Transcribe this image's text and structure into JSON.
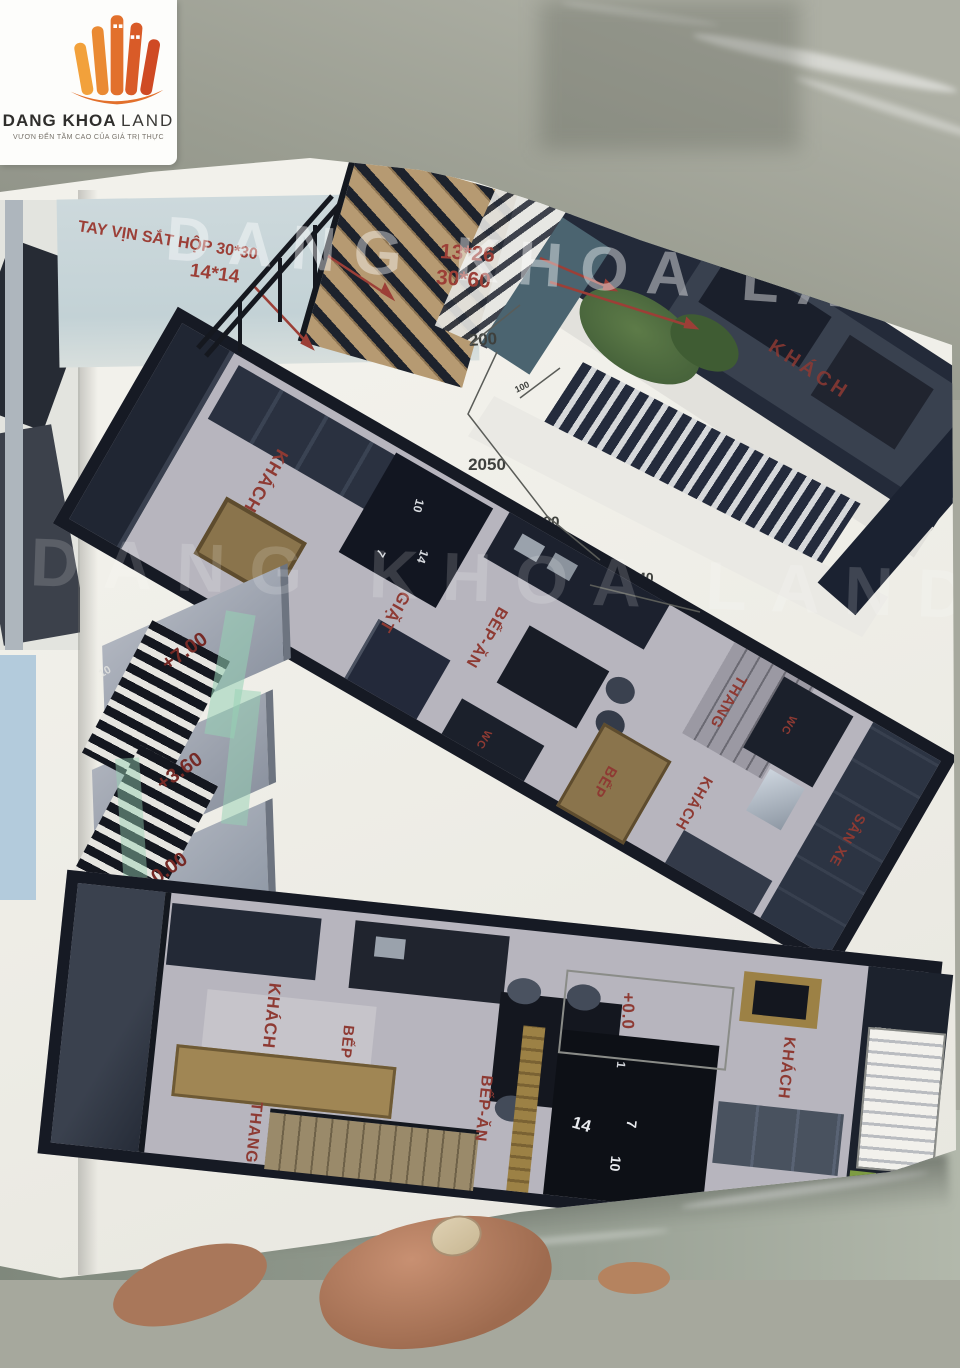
{
  "logo": {
    "brand_bold": "DANG KHOA",
    "brand_light": "LAND",
    "tagline": "VƯƠN ĐẾN TẦM CAO CỦA GIÁ TRỊ THỰC"
  },
  "watermark": {
    "main": "DANG KHOA LAND"
  },
  "colors": {
    "brand_orange": "#e8792f",
    "label_red": "#8e3a33",
    "paper": "#f0efe9",
    "marble": "#a6a89d",
    "plan_wall": "#161a24"
  },
  "annotations": {
    "handrail_note": "TAY VỊN SẮT HỘP 30*30",
    "post_size": "14*14",
    "step_size": "13*26",
    "stringer_size": "30*60"
  },
  "stair_detail": {
    "levels": [
      {
        "label": "+7.00"
      },
      {
        "label": "+3.60"
      },
      {
        "label": "+0.00"
      }
    ],
    "tread_number": "10"
  },
  "plan_top_right": {
    "rooms": [
      {
        "label": "KHÁCH"
      }
    ],
    "dims": [
      {
        "label": "200"
      },
      {
        "label": "100"
      },
      {
        "label": "2050"
      },
      {
        "label": "400"
      },
      {
        "label": "1240"
      }
    ]
  },
  "plan_middle": {
    "rooms": [
      {
        "label": "KHÁCH"
      },
      {
        "label": "GIẶT"
      },
      {
        "label": "BẾP-ĂN"
      },
      {
        "label": "WC"
      },
      {
        "label": "BẾP"
      },
      {
        "label": "THANG"
      },
      {
        "label": "WC"
      },
      {
        "label": "KHÁCH"
      },
      {
        "label": "SÂN XE"
      }
    ],
    "stair_numbers": [
      {
        "n": "10"
      },
      {
        "n": "14"
      },
      {
        "n": "7"
      }
    ]
  },
  "plan_bottom": {
    "level": "+0.0",
    "rooms": [
      {
        "label": "KHÁCH"
      },
      {
        "label": "BẾP"
      },
      {
        "label": "THANG"
      },
      {
        "label": "BẾP-ĂN"
      },
      {
        "label": "KHÁCH"
      }
    ],
    "stair_numbers": [
      {
        "n": "1"
      },
      {
        "n": "14"
      },
      {
        "n": "7"
      },
      {
        "n": "10"
      }
    ]
  }
}
